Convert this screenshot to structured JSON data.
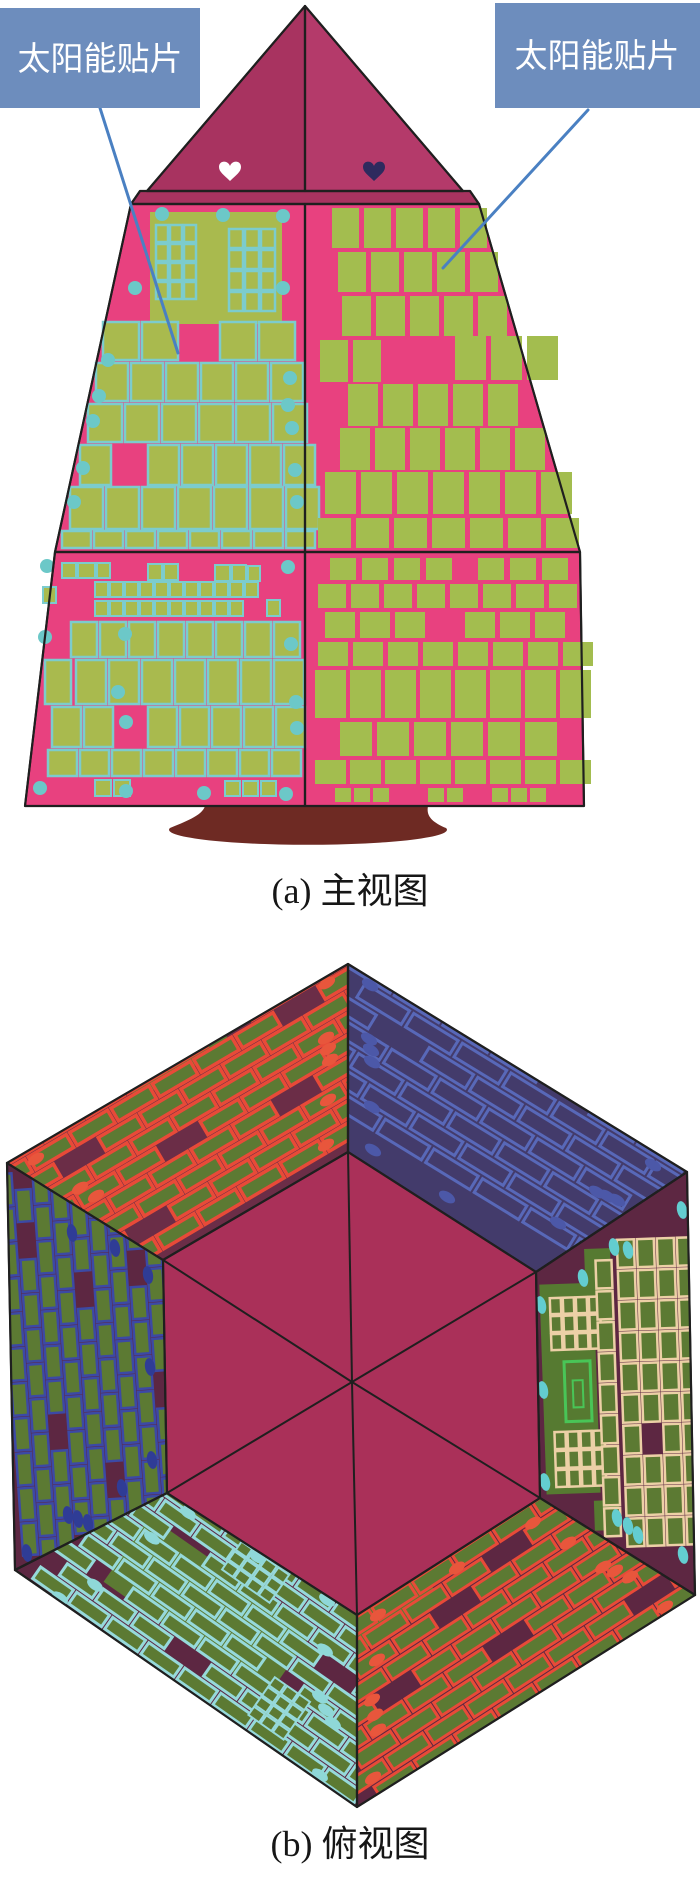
{
  "panel_a": {
    "caption": "(a) 主视图",
    "callout_left": "太阳能贴片",
    "callout_right": "太阳能贴片"
  },
  "panel_b": {
    "caption": "(b) 俯视图"
  },
  "palette": {
    "label_bg": "#6d8dbd",
    "label_text": "#ffffff",
    "leader_blue": "#4a80c2",
    "pyr_left": "#a83360",
    "pyr_right": "#b43a6a",
    "body_pink": "#e8417f",
    "tile_olive": "#a9ba4e",
    "tile_olive2": "#a3bd4f",
    "tile_outline_cyan": "#7ccccd",
    "dot_cyan": "#6cc8c8",
    "heart_white": "#ffffff",
    "heart_navy": "#2e2a5e",
    "base_maroon": "#6e2a23",
    "outline_black": "#1f1f1f",
    "caption_text": "#161616",
    "hex_face_maroon_light": "#6b2d47",
    "hex_face_navy": "#433b6b",
    "hex_face_maroon": "#5d2742",
    "hex_center": "#aa3059",
    "hex_tile_green": "#5c7a33",
    "hex_panel_green": "#567a31",
    "outline_red": "#e84a38",
    "outline_slate": "#5868b8",
    "outline_indigo": "#3c49a5",
    "outline_tan": "#ecd0a6",
    "outline_bright_green": "#49c557",
    "outline_pale_cyan": "#96d9da",
    "oval_red": "#e8563c",
    "oval_slate": "#4c58a8",
    "oval_indigo": "#2f3c96",
    "oval_cyan": "#63cdd0",
    "oval_pale_cyan": "#8fd8d8"
  }
}
